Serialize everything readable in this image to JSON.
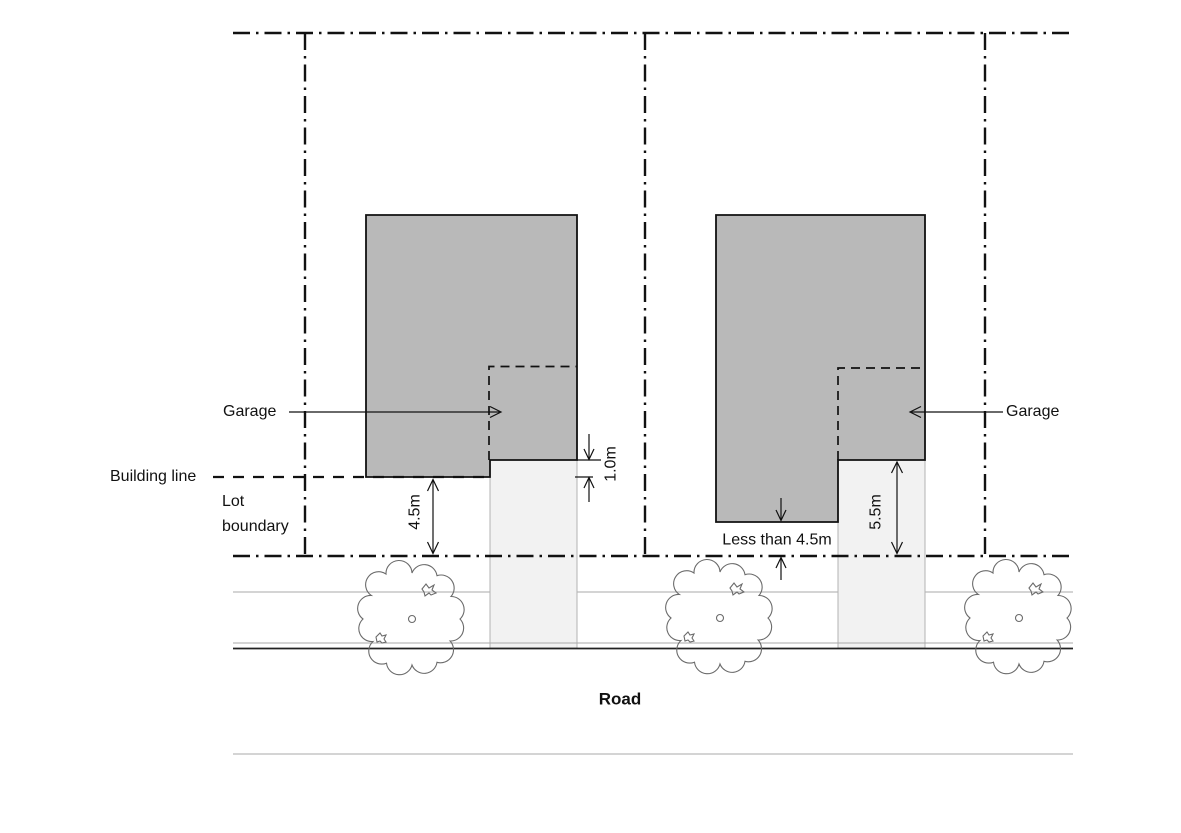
{
  "labels": {
    "garage_left": "Garage",
    "garage_right": "Garage",
    "building_line": "Building line",
    "lot_boundary": "Lot boundary",
    "road": "Road"
  },
  "dimensions": {
    "front_setback": "4.5m",
    "garage_behind_building_line": "1.0m",
    "garage_front_setback": "5.5m",
    "house_front_setback": "Less than 4.5m"
  },
  "colors": {
    "house_fill": "#b9b9b9",
    "driveway_fill": "#f2f2f2",
    "boundary_line": "#111111",
    "road_edge_gray": "#a9a9a9",
    "kerb_black": "#222222",
    "tree_outline": "#6b6b6b"
  }
}
